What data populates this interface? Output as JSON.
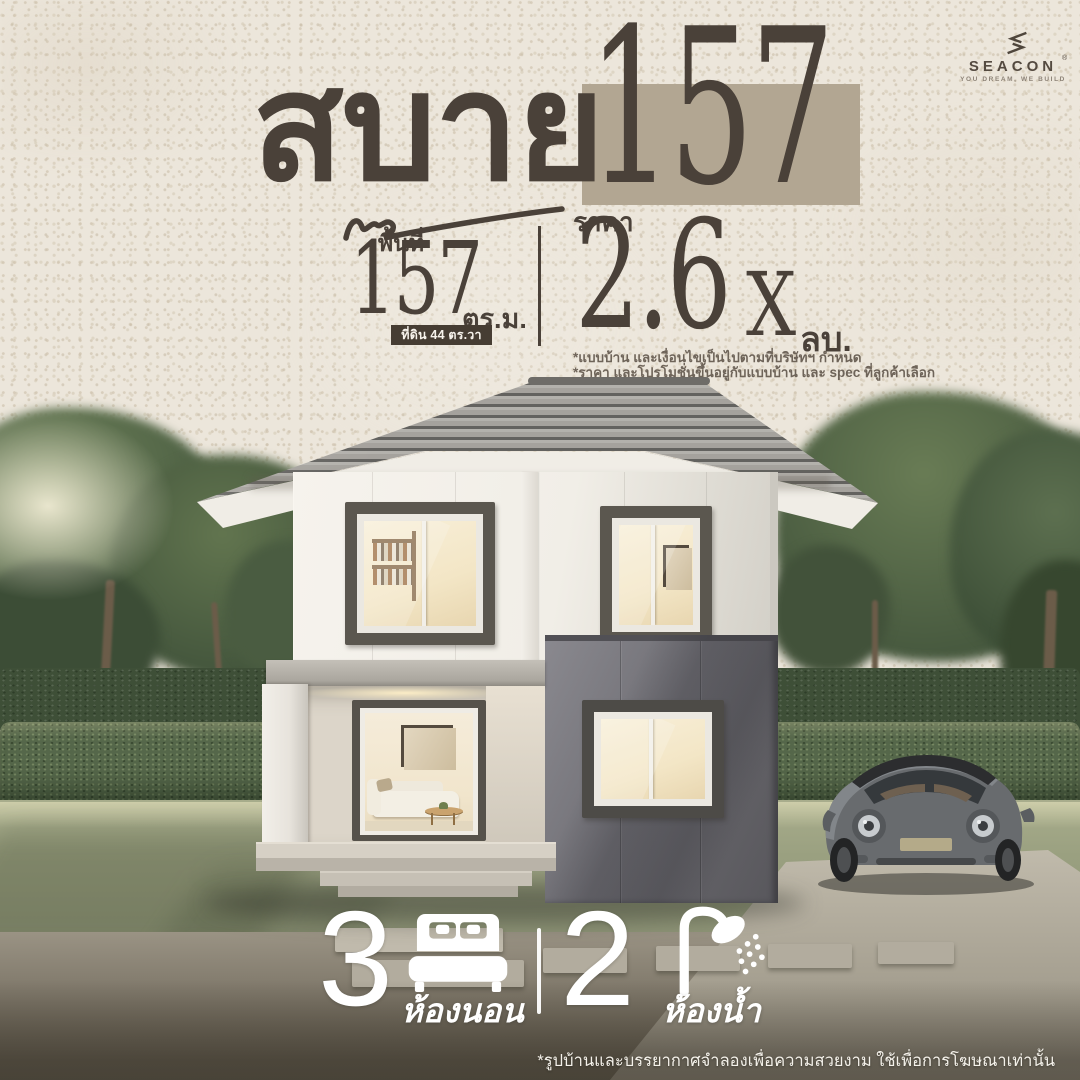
{
  "brand": {
    "logo_text": "SEACON",
    "registered_mark": "®",
    "tagline": "YOU DREAM, WE BUILD"
  },
  "title": {
    "name_th": "สบาย",
    "number": "157"
  },
  "stats": {
    "area": {
      "label": "พื้นที่",
      "value": "157",
      "unit": "ตร.ม.",
      "land_note": "ที่ดิน 44 ตร.วา"
    },
    "price": {
      "label": "ราคา",
      "value": "2.6",
      "masked_digit": "X",
      "unit": "ลบ.",
      "notes": [
        "*แบบบ้าน และเงื่อนไขเป็นไปตามที่บริษัทฯ กำหนด",
        "*ราคา และโปรโมชั่นขึ้นอยู่กับแบบบ้าน และ spec ที่ลูกค้าเลือก"
      ]
    }
  },
  "features": {
    "bedrooms": {
      "count": "3",
      "label": "ห้องนอน",
      "icon": "bed-icon"
    },
    "bathrooms": {
      "count": "2",
      "label": "ห้องน้ำ",
      "icon": "shower-icon"
    }
  },
  "footer": {
    "disclaimer": "*รูปบ้านและบรรยากาศจำลองเพื่อความสวยงาม ใช้เพื่อการโฆษณาเท่านั้น"
  },
  "colors": {
    "paper": "#ece6db",
    "ink": "#4a4139",
    "title_box_beige": "#b2a692",
    "land_box_dark": "#463d33",
    "white": "#ffffff",
    "roof_tile": "#a5a29d",
    "wall_white": "#f1eee7",
    "wall_dark_gray": "#6e6d72",
    "hedge_green": "#55674a",
    "lawn_green": "#9aa080",
    "road_gray": "#837c6e"
  }
}
